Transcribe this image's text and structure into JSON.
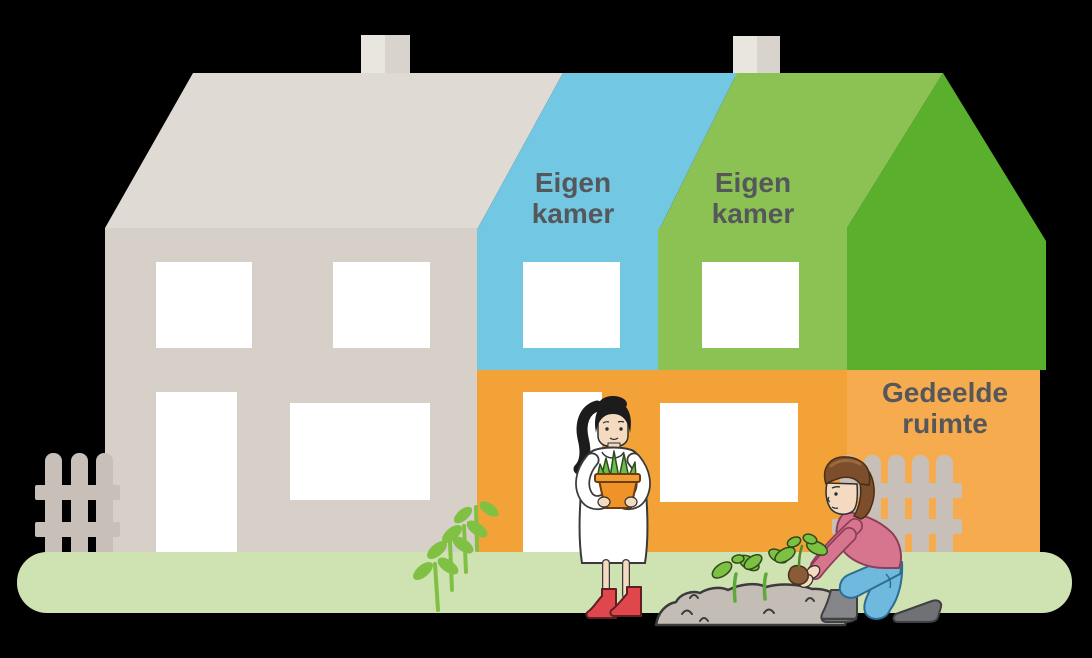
{
  "scene": {
    "background_color": "#000000",
    "labels": {
      "blue_room": "Eigen kamer",
      "green_room": "Eigen kamer",
      "shared_space": "Gedeelde ruimte"
    },
    "label_text_color": "#55575B",
    "colors": {
      "neighbor_roof": "#DFDAD3",
      "neighbor_wall": "#D6D0C9",
      "chimney_light": "#E9E5DF",
      "chimney_dark": "#D8D3CC",
      "room_blue": "#72C7E2",
      "room_green": "#8CC154",
      "roof_side_green": "#5AB02C",
      "orange_front": "#F3A238",
      "orange_side": "#F6AC4E",
      "window_white": "#FFFFFF",
      "grass_green": "#CFE3B2",
      "fence_gray": "#C8C0B8",
      "sprout_green": "#80C143",
      "leaf_green": "#7CC142",
      "dirt_gray": "#C3BDB5",
      "soil_brown": "#8A5B39",
      "skin": "#F4DAC0",
      "hair_black": "#1C1C1C",
      "hair_brown": "#7C4E2B",
      "dress_white": "#FFFFFF",
      "boots_red": "#E0474D",
      "pot_orange": "#EF9227",
      "sweater_pink": "#D7758E",
      "jeans_blue": "#6FB9DE",
      "boots_gray": "#84868A"
    },
    "figures": {
      "left_figure": "woman holding potted plant",
      "right_figure": "person kneeling planting a seedling"
    }
  }
}
